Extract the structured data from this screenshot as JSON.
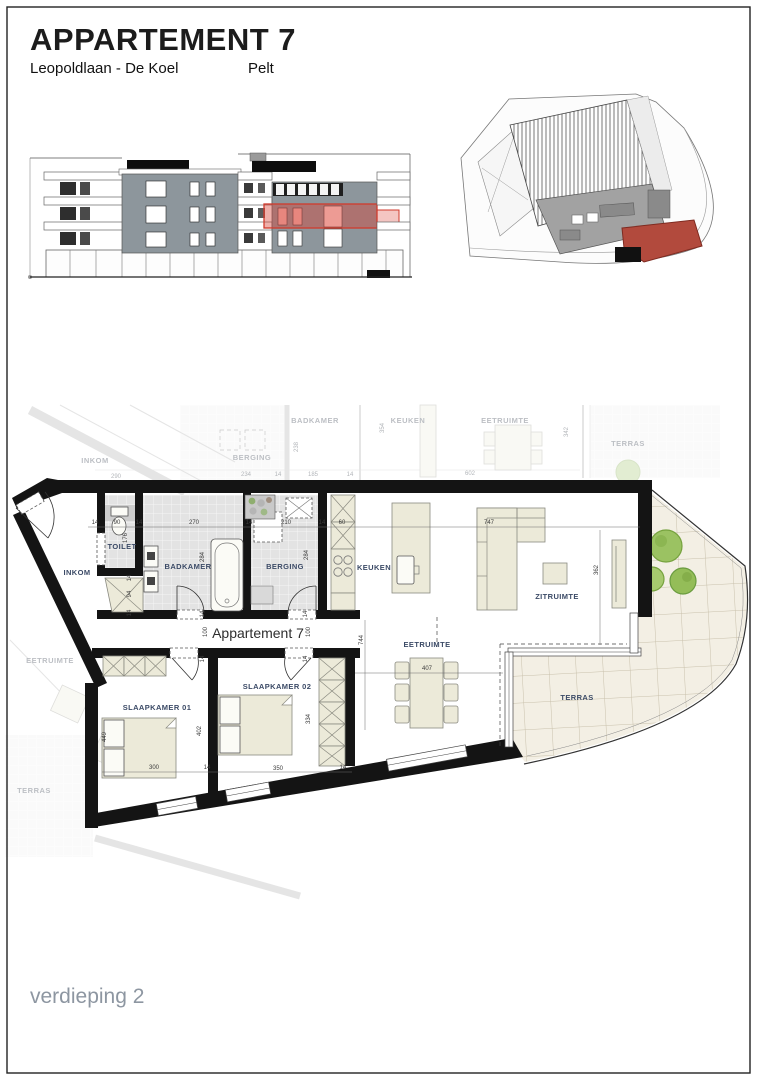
{
  "title_block": {
    "title": "APPARTEMENT 7",
    "address": "Leopoldlaan - De Koel",
    "city": "Pelt"
  },
  "footer": {
    "floor_label": "verdieping 2"
  },
  "colors": {
    "highlight_red": "#d03a2c",
    "site_red": "#b24a3d",
    "facade_gray": "#8d969c",
    "room_label_blue": "#3b4a66",
    "terrace_tile": "#f3efe4",
    "tree_green": "#9bc262"
  },
  "floor_plan": {
    "apartment_label": "Appartement 7",
    "room_labels": [
      {
        "id": "inkom",
        "text": "INKOM",
        "x": 77,
        "y": 575
      },
      {
        "id": "toilet",
        "text": "TOILET",
        "x": 122,
        "y": 549
      },
      {
        "id": "badkamer",
        "text": "BADKAMER",
        "x": 188,
        "y": 569
      },
      {
        "id": "berging",
        "text": "BERGING",
        "x": 285,
        "y": 569
      },
      {
        "id": "keuken",
        "text": "KEUKEN",
        "x": 374,
        "y": 570
      },
      {
        "id": "zitruimte",
        "text": "ZITRUIMTE",
        "x": 557,
        "y": 599
      },
      {
        "id": "eetruimte",
        "text": "EETRUIMTE",
        "x": 427,
        "y": 647
      },
      {
        "id": "slaapkamer-01",
        "text": "SLAAPKAMER 01",
        "x": 157,
        "y": 710
      },
      {
        "id": "slaapkamer-02",
        "text": "SLAAPKAMER 02",
        "x": 277,
        "y": 689
      },
      {
        "id": "terras",
        "text": "TERRAS",
        "x": 577,
        "y": 700
      }
    ],
    "background_labels": [
      {
        "text": "INKOM",
        "x": 95,
        "y": 463
      },
      {
        "text": "BERGING",
        "x": 252,
        "y": 460
      },
      {
        "text": "BADKAMER",
        "x": 315,
        "y": 423
      },
      {
        "text": "KEUKEN",
        "x": 408,
        "y": 423
      },
      {
        "text": "EETRUIMTE",
        "x": 505,
        "y": 423
      },
      {
        "text": "TERRAS",
        "x": 628,
        "y": 446
      },
      {
        "text": "EETRUIMTE",
        "x": 50,
        "y": 663
      },
      {
        "text": "TERRAS",
        "x": 34,
        "y": 793
      }
    ],
    "dimensions": [
      {
        "text": "14",
        "x": 95,
        "y": 524
      },
      {
        "text": "90",
        "x": 117,
        "y": 524
      },
      {
        "text": "14",
        "x": 139,
        "y": 524
      },
      {
        "text": "270",
        "x": 194,
        "y": 524
      },
      {
        "text": "14",
        "x": 249,
        "y": 524
      },
      {
        "text": "210",
        "x": 286,
        "y": 524
      },
      {
        "text": "14",
        "x": 322,
        "y": 524
      },
      {
        "text": "60",
        "x": 342,
        "y": 524
      },
      {
        "text": "747",
        "x": 489,
        "y": 524
      },
      {
        "text": "176",
        "x": 127,
        "y": 538,
        "rot": -90
      },
      {
        "text": "284",
        "x": 204,
        "y": 557,
        "rot": -90
      },
      {
        "text": "284",
        "x": 308,
        "y": 555,
        "rot": -90
      },
      {
        "text": "14",
        "x": 131,
        "y": 578,
        "rot": -90
      },
      {
        "text": "94",
        "x": 131,
        "y": 594,
        "rot": -90
      },
      {
        "text": "14",
        "x": 131,
        "y": 613,
        "rot": -90
      },
      {
        "text": "14",
        "x": 204,
        "y": 614,
        "rot": -90
      },
      {
        "text": "100",
        "x": 207,
        "y": 632,
        "rot": -90
      },
      {
        "text": "14",
        "x": 204,
        "y": 659,
        "rot": -90
      },
      {
        "text": "14",
        "x": 307,
        "y": 614,
        "rot": -90
      },
      {
        "text": "100",
        "x": 310,
        "y": 632,
        "rot": -90
      },
      {
        "text": "14",
        "x": 307,
        "y": 659,
        "rot": -90
      },
      {
        "text": "744",
        "x": 363,
        "y": 640,
        "rot": -90
      },
      {
        "text": "407",
        "x": 427,
        "y": 670
      },
      {
        "text": "362",
        "x": 598,
        "y": 570,
        "rot": -90
      },
      {
        "text": "449",
        "x": 106,
        "y": 737,
        "rot": -90
      },
      {
        "text": "402",
        "x": 201,
        "y": 731,
        "rot": -90
      },
      {
        "text": "334",
        "x": 310,
        "y": 719,
        "rot": -90
      },
      {
        "text": "300",
        "x": 154,
        "y": 769
      },
      {
        "text": "14",
        "x": 207,
        "y": 769
      },
      {
        "text": "350",
        "x": 278,
        "y": 770
      },
      {
        "text": "14",
        "x": 343,
        "y": 769
      }
    ],
    "background_dimensions": [
      {
        "text": "290",
        "x": 116,
        "y": 478
      },
      {
        "text": "234",
        "x": 246,
        "y": 476
      },
      {
        "text": "14",
        "x": 278,
        "y": 476
      },
      {
        "text": "185",
        "x": 313,
        "y": 476
      },
      {
        "text": "14",
        "x": 350,
        "y": 476
      },
      {
        "text": "602",
        "x": 470,
        "y": 475
      },
      {
        "text": "238",
        "x": 298,
        "y": 447,
        "rot": -90
      },
      {
        "text": "354",
        "x": 384,
        "y": 428,
        "rot": -90
      },
      {
        "text": "342",
        "x": 568,
        "y": 432,
        "rot": -90
      }
    ]
  }
}
